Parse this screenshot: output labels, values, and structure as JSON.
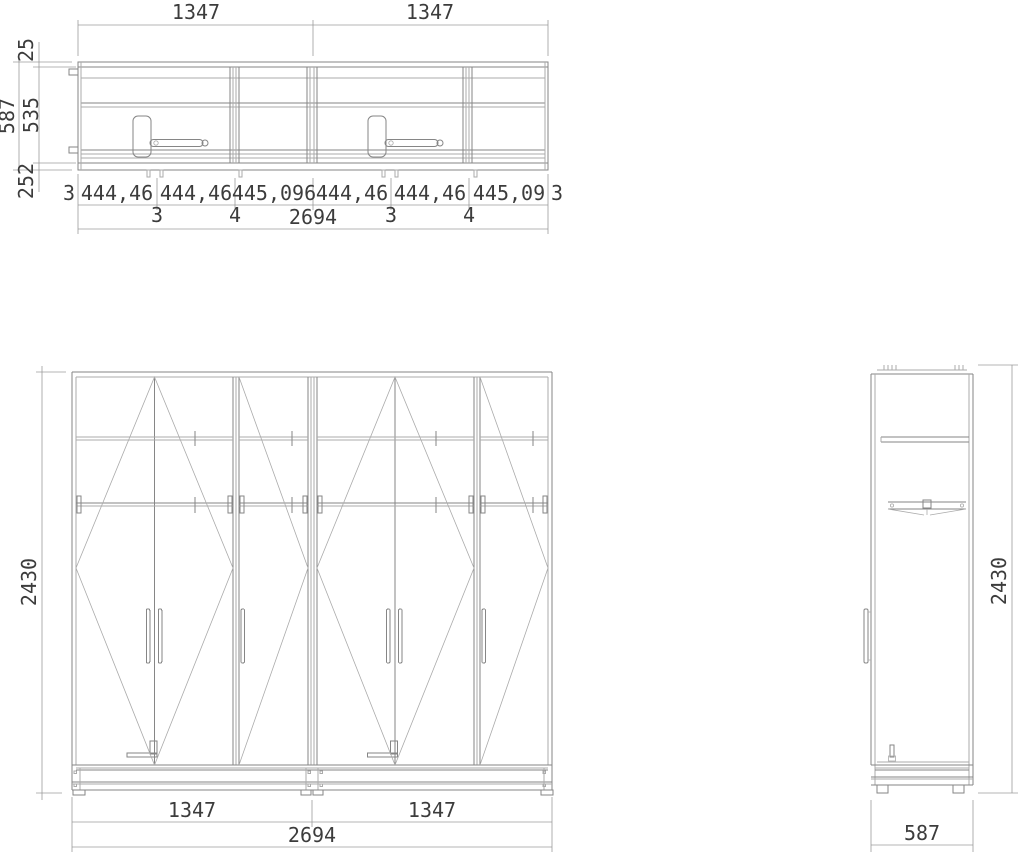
{
  "window": {
    "background": "#ffffff"
  },
  "colors": {
    "line": "#868686",
    "line_light": "#ababab",
    "line_dark": "#6e6e6e",
    "dimension_line": "#9b9b9b",
    "text": "#3c3c3c"
  },
  "drawing": {
    "plan": {
      "top_widths": [
        "1347",
        "1347"
      ],
      "depth": {
        "overall": "587",
        "interior": "535",
        "front": "25",
        "rear": "252"
      },
      "segment_chain": [
        "3",
        "444,46",
        "444,46",
        "445,096",
        "444,46",
        "444,46",
        "445,09",
        "3"
      ],
      "gap_labels": [
        "3",
        "4",
        "3",
        "4"
      ],
      "overall_width": "2694"
    },
    "front": {
      "overall_height": "2430",
      "module_widths": [
        "1347",
        "1347"
      ],
      "overall_width": "2694"
    },
    "side": {
      "overall_height": "2430",
      "overall_depth": "587"
    }
  }
}
